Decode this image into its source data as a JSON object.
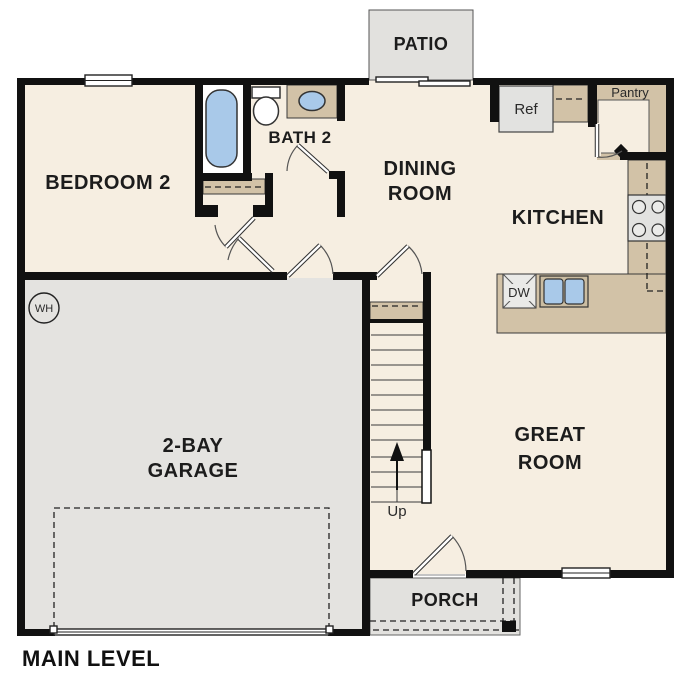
{
  "title": "MAIN LEVEL",
  "rooms": {
    "bedroom2": "BEDROOM 2",
    "bath2": "BATH 2",
    "dining_line1": "DINING",
    "dining_line2": "ROOM",
    "kitchen": "KITCHEN",
    "great_line1": "GREAT",
    "great_line2": "ROOM",
    "garage_line1": "2-BAY",
    "garage_line2": "GARAGE",
    "pantry": "Pantry",
    "patio": "PATIO",
    "porch": "PORCH"
  },
  "fixtures": {
    "refrigerator": "Ref",
    "dishwasher": "DW",
    "water_heater": "WH",
    "stairs_direction": "Up"
  },
  "colors": {
    "floor": "#f6eee1",
    "garage_floor": "#e4e3e0",
    "outdoor": "#e2e1de",
    "counter": "#d2c2a7",
    "fixture_blue": "#a9c9e9",
    "appliance_gray": "#e2e2e0",
    "wall": "#111111"
  }
}
